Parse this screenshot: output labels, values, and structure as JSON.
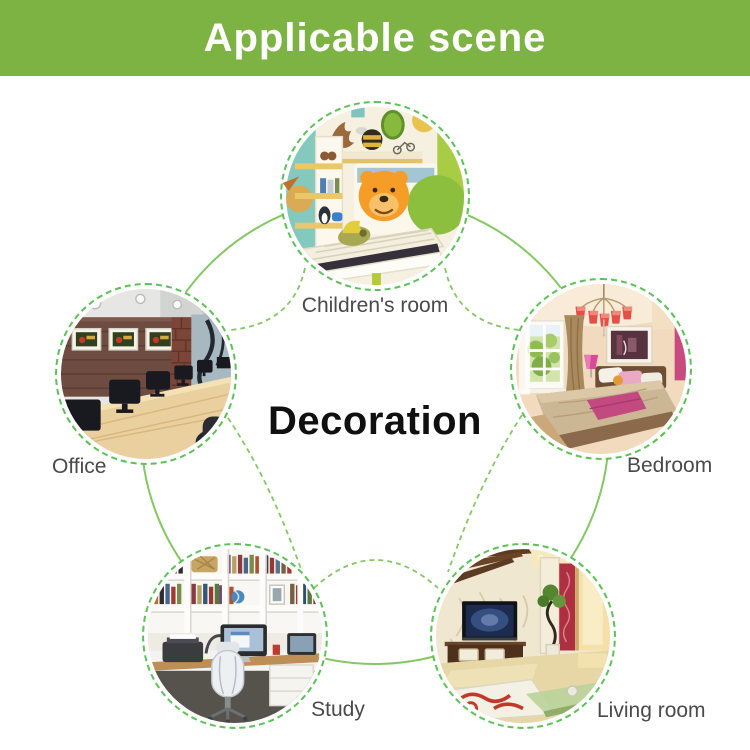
{
  "header": {
    "title": "Applicable scene",
    "background_color": "#7cb342",
    "text_color": "#ffffff"
  },
  "center": {
    "label": "Decoration",
    "color": "#101010"
  },
  "scenes": [
    {
      "id": "children-room",
      "label": "Children's room",
      "position": "top"
    },
    {
      "id": "office",
      "label": "Office",
      "position": "left"
    },
    {
      "id": "bedroom",
      "label": "Bedroom",
      "position": "right"
    },
    {
      "id": "study",
      "label": "Study",
      "position": "bottom-left"
    },
    {
      "id": "living-room",
      "label": "Living room",
      "position": "bottom-right"
    }
  ],
  "diagram": {
    "ring_color": "#85c763",
    "tile_border_color": "#5cc157",
    "arrow_color": "#bf7030",
    "label_color": "#4a4a4a",
    "arrow_icon": "flow-arrow-icon"
  }
}
